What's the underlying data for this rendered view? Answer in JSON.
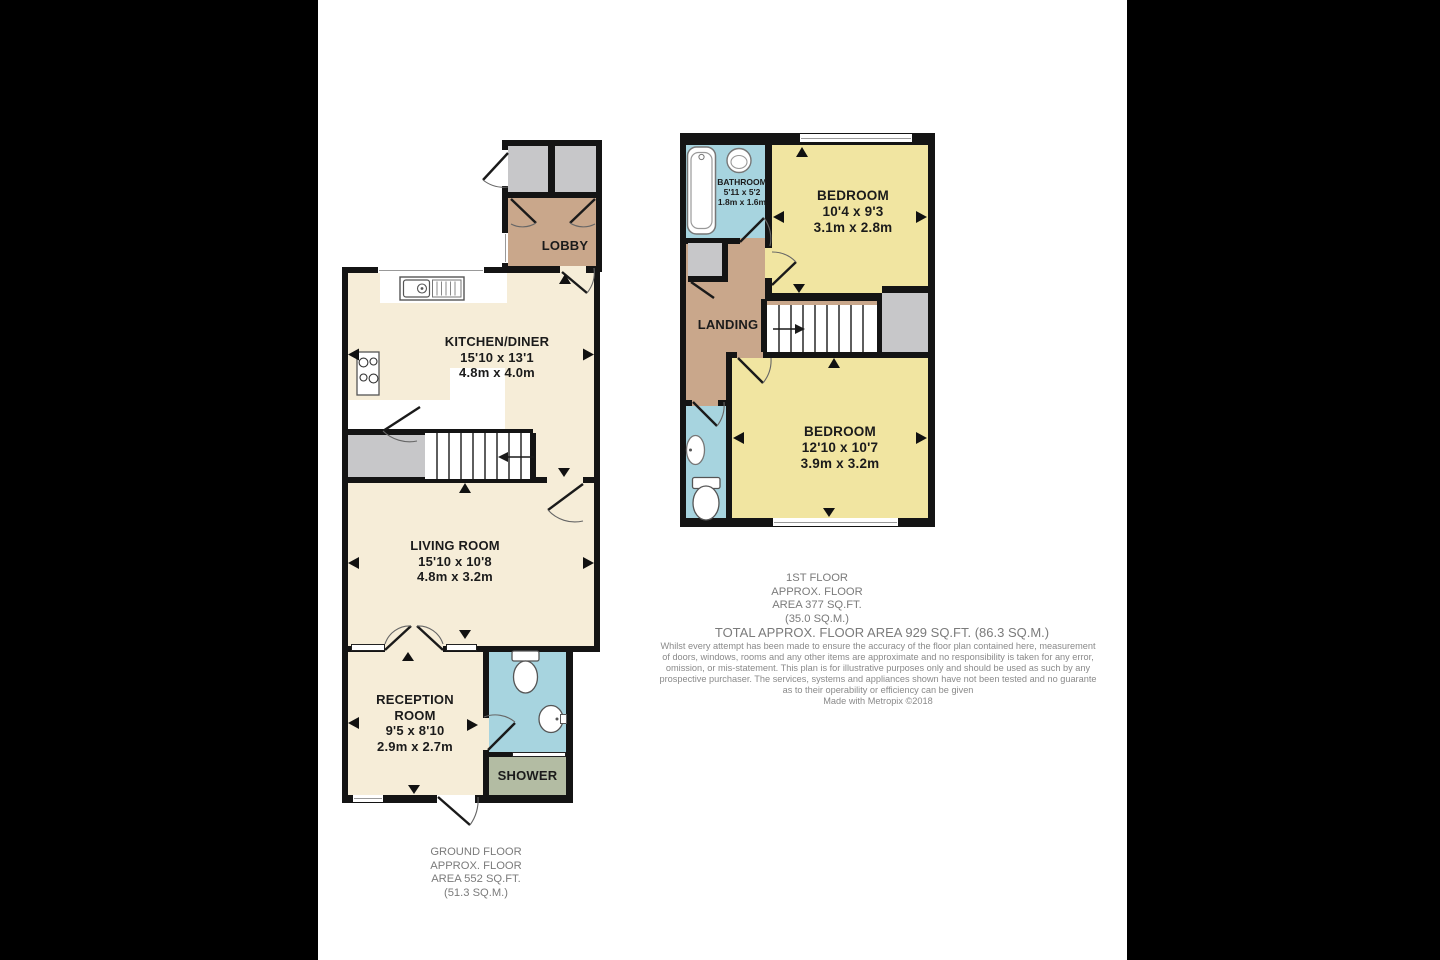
{
  "ground_floor": {
    "rooms": {
      "lobby": {
        "label": "LOBBY"
      },
      "kitchen_diner": {
        "label": "KITCHEN/DINER",
        "dims_ft": "15'10 x 13'1",
        "dims_m": "4.8m x 4.0m"
      },
      "living_room": {
        "label": "LIVING ROOM",
        "dims_ft": "15'10 x 10'8",
        "dims_m": "4.8m x 3.2m"
      },
      "reception_room": {
        "label": "RECEPTION ROOM",
        "dims_ft": "9'5 x 8'10",
        "dims_m": "2.9m x 2.7m"
      },
      "shower": {
        "label": "SHOWER"
      }
    },
    "caption": {
      "line1": "GROUND FLOOR",
      "line2": "APPROX. FLOOR",
      "line3": "AREA 552 SQ.FT.",
      "line4": "(51.3 SQ.M.)"
    }
  },
  "first_floor": {
    "rooms": {
      "bathroom": {
        "label": "BATHROOM",
        "dims_ft": "5'11 x 5'2",
        "dims_m": "1.8m x 1.6m"
      },
      "bedroom_front": {
        "label": "BEDROOM",
        "dims_ft": "10'4 x 9'3",
        "dims_m": "3.1m x 2.8m"
      },
      "landing": {
        "label": "LANDING"
      },
      "bedroom_back": {
        "label": "BEDROOM",
        "dims_ft": "12'10 x 10'7",
        "dims_m": "3.9m x 3.2m"
      }
    },
    "caption": {
      "line1": "1ST FLOOR",
      "line2": "APPROX. FLOOR",
      "line3": "AREA 377 SQ.FT.",
      "line4": "(35.0 SQ.M.)"
    }
  },
  "summary": {
    "total": "TOTAL APPROX. FLOOR AREA 929 SQ.FT. (86.3 SQ.M.)",
    "disclaimer": {
      "line1": "Whilst every attempt has been made to ensure the accuracy of the floor plan contained here, measurement",
      "line2": "of doors, windows, rooms and any other items are approximate and no responsibility is taken for any error,",
      "line3": "omission, or mis-statement. This plan is for illustrative purposes only and should be used as such by any",
      "line4": "prospective purchaser. The services, systems and appliances shown have not been tested and no guarante",
      "line5": "as to their operability or efficiency can be given",
      "line6": "Made with Metropix ©2018"
    }
  },
  "colors": {
    "room_cream": "#F6EDD8",
    "room_yellow": "#F1E5A1",
    "hall_tan": "#C9A78B",
    "wet_blue": "#A7D4DF",
    "shower_olive": "#B3BCA3",
    "storage_gray": "#C7C7C9",
    "wall_black": "#141414",
    "caption_gray": "#7B7B7B"
  }
}
